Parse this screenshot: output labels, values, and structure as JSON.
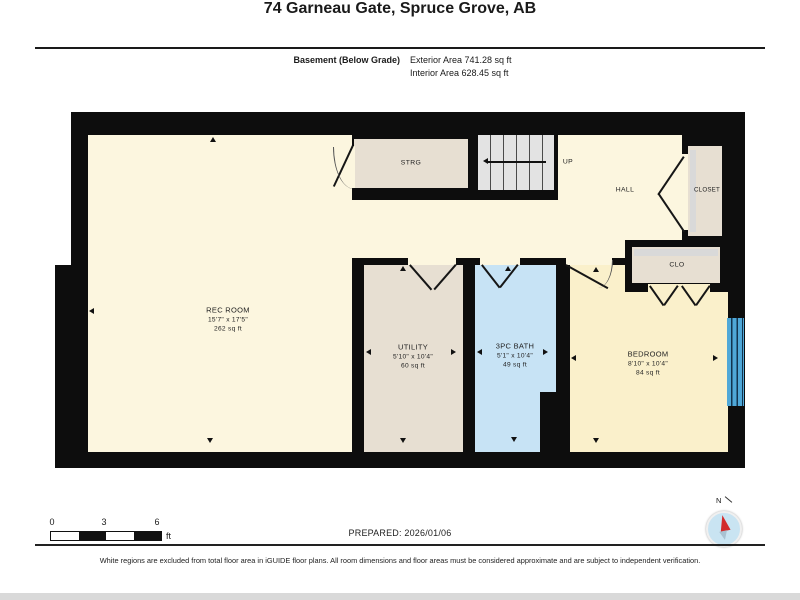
{
  "header": {
    "title": "74 Garneau Gate, Spruce Grove, AB",
    "floor_label": "Basement (Below Grade)",
    "exterior_area": "Exterior Area 741.28 sq ft",
    "interior_area": "Interior Area 628.45 sq ft"
  },
  "rooms": {
    "rec_room": {
      "name": "REC ROOM",
      "dims": "15'7\" x 17'5\"",
      "area": "262 sq ft"
    },
    "utility": {
      "name": "UTILITY",
      "dims": "5'10\" x 10'4\"",
      "area": "60 sq ft"
    },
    "bath": {
      "name": "3PC BATH",
      "dims": "5'1\" x 10'4\"",
      "area": "49 sq ft"
    },
    "bedroom": {
      "name": "BEDROOM",
      "dims": "8'10\" x 10'4\"",
      "area": "84 sq ft"
    },
    "strg": {
      "name": "STRG"
    },
    "hall": {
      "name": "HALL"
    },
    "closet": {
      "name": "CLOSET"
    },
    "clo": {
      "name": "CLO"
    },
    "stairs": {
      "direction_label": "UP"
    }
  },
  "scale_bar": {
    "ticks": [
      "0",
      "3",
      "6"
    ],
    "unit": "ft"
  },
  "compass": {
    "label": "N"
  },
  "footer": {
    "prepared": "PREPARED: 2026/01/06",
    "disclaimer": "White regions are excluded from total floor area in iGUIDE floor plans. All room dimensions and floor areas must be considered approximate and are subject to independent verification."
  },
  "colors": {
    "wall": "#0D0D0D",
    "floor_cream": "#FCF6DF",
    "floor_tan": "#E7DFD2",
    "floor_blue": "#C7E3F5",
    "floor_bedroom": "#FAF0CB",
    "window_blue": "#4FA8D8",
    "stairs_gray": "#E3E3E3",
    "compass_red": "#D22B2B"
  }
}
